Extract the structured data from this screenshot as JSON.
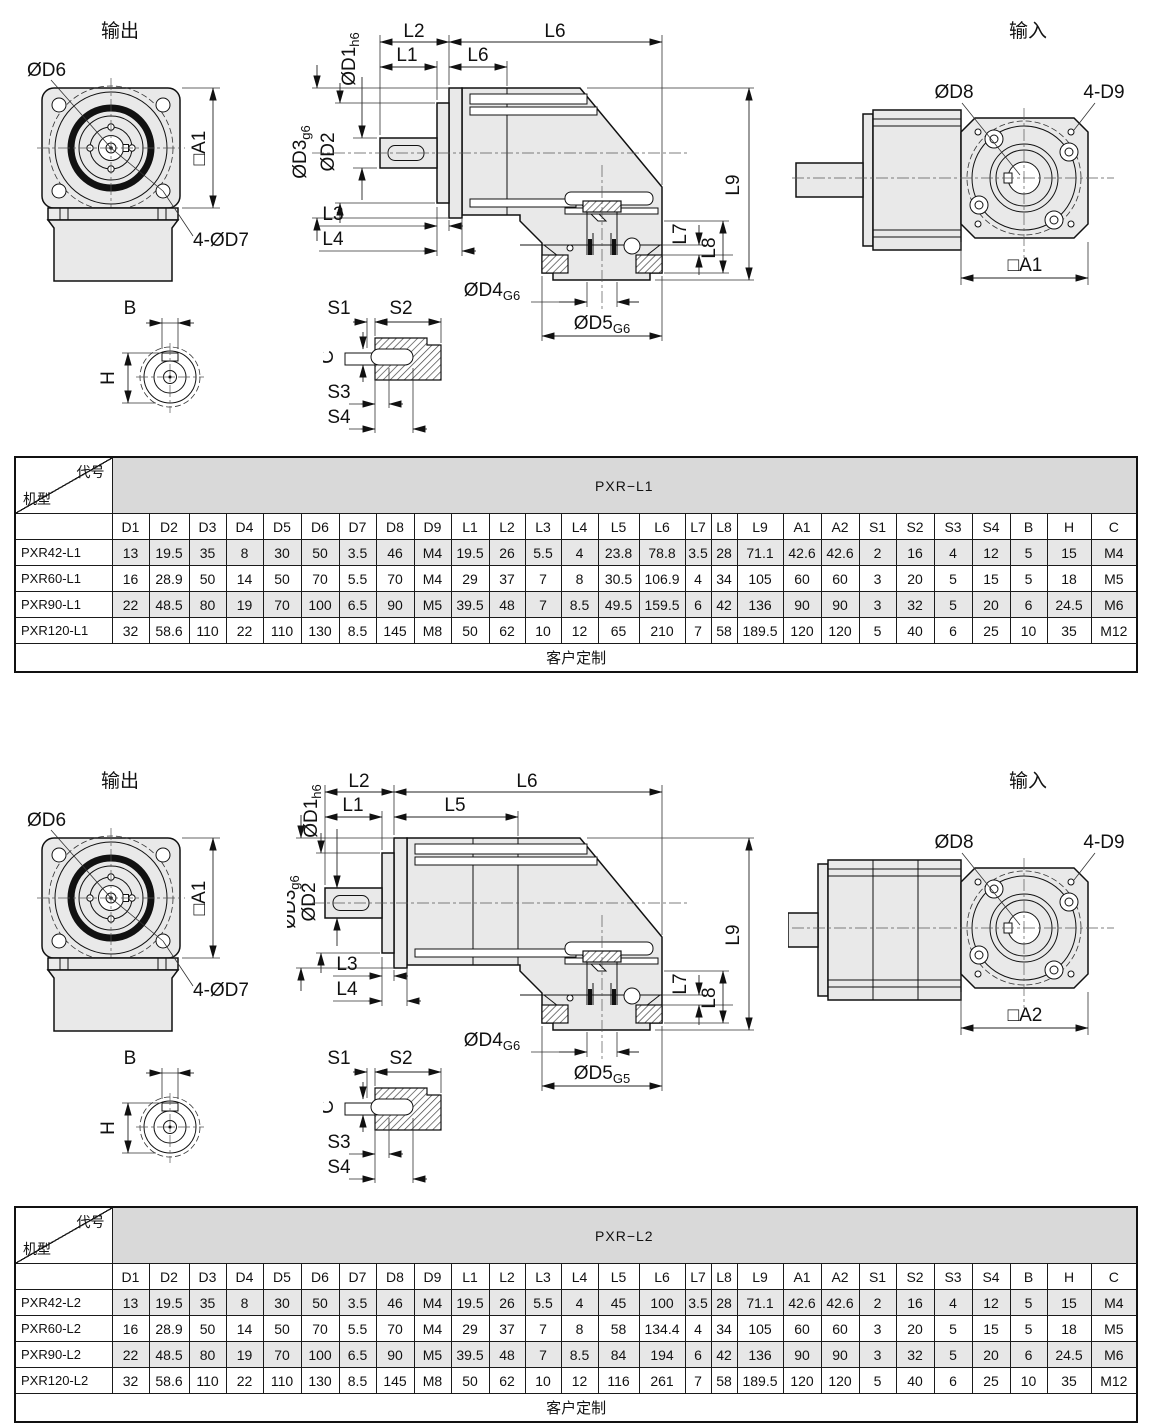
{
  "sections": [
    {
      "output_title": "输出",
      "input_title": "输入",
      "labels": {
        "od6": "ØD6",
        "sq_a_out": "□A1",
        "d7": "4-ØD7",
        "l1": "L1",
        "l2": "L2",
        "l6": "L6",
        "l5": "L6",
        "od1": "ØD1",
        "od1s": "h6",
        "od2": "ØD2",
        "od3": "ØD3",
        "od3s": "g6",
        "l3": "L3",
        "l4": "L4",
        "od4": "ØD4",
        "od4s": "G6",
        "od5": "ØD5",
        "od5s": "G6",
        "l7": "L7",
        "l8": "L8",
        "l9": "L9",
        "od8": "ØD8",
        "d9": "4-D9",
        "sq_a_in": "□A1",
        "b": "B",
        "h": "H",
        "s1": "S1",
        "s2": "S2",
        "c": "C",
        "s3": "S3",
        "s4": "S4"
      },
      "table": {
        "corner_top": "代号",
        "corner_bottom": "机型",
        "title": "PXR−L1",
        "columns": [
          "D1",
          "D2",
          "D3",
          "D4",
          "D5",
          "D6",
          "D7",
          "D8",
          "D9",
          "L1",
          "L2",
          "L3",
          "L4",
          "L5",
          "L6",
          "L7",
          "L8",
          "L9",
          "A1",
          "A2",
          "S1",
          "S2",
          "S3",
          "S4",
          "B",
          "H",
          "C"
        ],
        "rows": [
          {
            "model": "PXR42-L1",
            "values": [
              "13",
              "19.5",
              "35",
              "8",
              "30",
              "50",
              "3.5",
              "46",
              "M4",
              "19.5",
              "26",
              "5.5",
              "4",
              "23.8",
              "78.8",
              "3.5",
              "28",
              "71.1",
              "42.6",
              "42.6",
              "2",
              "16",
              "4",
              "12",
              "5",
              "15",
              "M4"
            ]
          },
          {
            "model": "PXR60-L1",
            "values": [
              "16",
              "28.9",
              "50",
              "14",
              "50",
              "70",
              "5.5",
              "70",
              "M4",
              "29",
              "37",
              "7",
              "8",
              "30.5",
              "106.9",
              "4",
              "34",
              "105",
              "60",
              "60",
              "3",
              "20",
              "5",
              "15",
              "5",
              "18",
              "M5"
            ]
          },
          {
            "model": "PXR90-L1",
            "values": [
              "22",
              "48.5",
              "80",
              "19",
              "70",
              "100",
              "6.5",
              "90",
              "M5",
              "39.5",
              "48",
              "7",
              "8.5",
              "49.5",
              "159.5",
              "6",
              "42",
              "136",
              "90",
              "90",
              "3",
              "32",
              "5",
              "20",
              "6",
              "24.5",
              "M6"
            ]
          },
          {
            "model": "PXR120-L1",
            "values": [
              "32",
              "58.6",
              "110",
              "22",
              "110",
              "130",
              "8.5",
              "145",
              "M8",
              "50",
              "62",
              "10",
              "12",
              "65",
              "210",
              "7",
              "58",
              "189.5",
              "120",
              "120",
              "5",
              "40",
              "6",
              "25",
              "10",
              "35",
              "M12"
            ]
          }
        ],
        "footer": "客户定制"
      }
    },
    {
      "output_title": "输出",
      "input_title": "输入",
      "labels": {
        "od6": "ØD6",
        "sq_a_out": "□A1",
        "d7": "4-ØD7",
        "l1": "L1",
        "l2": "L2",
        "l6": "L6",
        "l5": "L5",
        "od1": "ØD1",
        "od1s": "h6",
        "od2": "ØD2",
        "od3": "ØD3",
        "od3s": "g6",
        "l3": "L3",
        "l4": "L4",
        "od4": "ØD4",
        "od4s": "G6",
        "od5": "ØD5",
        "od5s": "G5",
        "l7": "L7",
        "l8": "L8",
        "l9": "L9",
        "od8": "ØD8",
        "d9": "4-D9",
        "sq_a_in": "□A2",
        "b": "B",
        "h": "H",
        "s1": "S1",
        "s2": "S2",
        "c": "C",
        "s3": "S3",
        "s4": "S4"
      },
      "table": {
        "corner_top": "代号",
        "corner_bottom": "机型",
        "title": "PXR−L2",
        "columns": [
          "D1",
          "D2",
          "D3",
          "D4",
          "D5",
          "D6",
          "D7",
          "D8",
          "D9",
          "L1",
          "L2",
          "L3",
          "L4",
          "L5",
          "L6",
          "L7",
          "L8",
          "L9",
          "A1",
          "A2",
          "S1",
          "S2",
          "S3",
          "S4",
          "B",
          "H",
          "C"
        ],
        "rows": [
          {
            "model": "PXR42-L2",
            "values": [
              "13",
              "19.5",
              "35",
              "8",
              "30",
              "50",
              "3.5",
              "46",
              "M4",
              "19.5",
              "26",
              "5.5",
              "4",
              "45",
              "100",
              "3.5",
              "28",
              "71.1",
              "42.6",
              "42.6",
              "2",
              "16",
              "4",
              "12",
              "5",
              "15",
              "M4"
            ]
          },
          {
            "model": "PXR60-L2",
            "values": [
              "16",
              "28.9",
              "50",
              "14",
              "50",
              "70",
              "5.5",
              "70",
              "M4",
              "29",
              "37",
              "7",
              "8",
              "58",
              "134.4",
              "4",
              "34",
              "105",
              "60",
              "60",
              "3",
              "20",
              "5",
              "15",
              "5",
              "18",
              "M5"
            ]
          },
          {
            "model": "PXR90-L2",
            "values": [
              "22",
              "48.5",
              "80",
              "19",
              "70",
              "100",
              "6.5",
              "90",
              "M5",
              "39.5",
              "48",
              "7",
              "8.5",
              "84",
              "194",
              "6",
              "42",
              "136",
              "90",
              "90",
              "3",
              "32",
              "5",
              "20",
              "6",
              "24.5",
              "M6"
            ]
          },
          {
            "model": "PXR120-L2",
            "values": [
              "32",
              "58.6",
              "110",
              "22",
              "110",
              "130",
              "8.5",
              "145",
              "M8",
              "50",
              "62",
              "10",
              "12",
              "116",
              "261",
              "7",
              "58",
              "189.5",
              "120",
              "120",
              "5",
              "40",
              "6",
              "25",
              "10",
              "35",
              "M12"
            ]
          }
        ],
        "footer": "客户定制"
      }
    }
  ]
}
